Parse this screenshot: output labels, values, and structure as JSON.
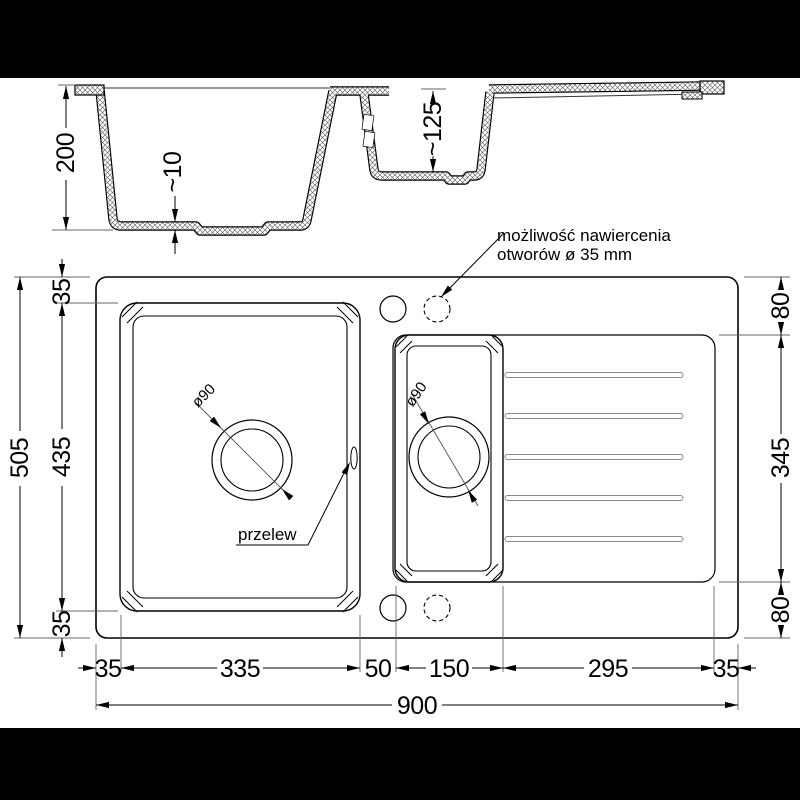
{
  "drawing_title": "sink-technical-drawing",
  "section_view": {
    "depth_main": "200",
    "floor_thickness": "~10",
    "depth_small": "~125"
  },
  "plan_view": {
    "left_dims": {
      "total_height": "505",
      "margin_top": "35",
      "bowl_height": "435",
      "margin_bottom": "35"
    },
    "right_dims": {
      "top_offset": "80",
      "drainer_height": "345",
      "bottom_offset": "80"
    },
    "bottom_dims": {
      "left_margin": "35",
      "main_bowl_width": "335",
      "divider_width": "50",
      "small_bowl_width": "150",
      "drainer_width": "295",
      "right_margin": "35",
      "total_width": "900"
    },
    "annotations": {
      "drain_main": "ø90",
      "drain_small": "ø90",
      "overflow_label": "przelew",
      "holes_note_line1": "możliwość nawiercenia",
      "holes_note_line2": "otworów ø 35 mm"
    }
  },
  "colors": {
    "line": "#000000",
    "background": "#ffffff",
    "letterbox": "#000000",
    "extension_line": "#666666"
  }
}
